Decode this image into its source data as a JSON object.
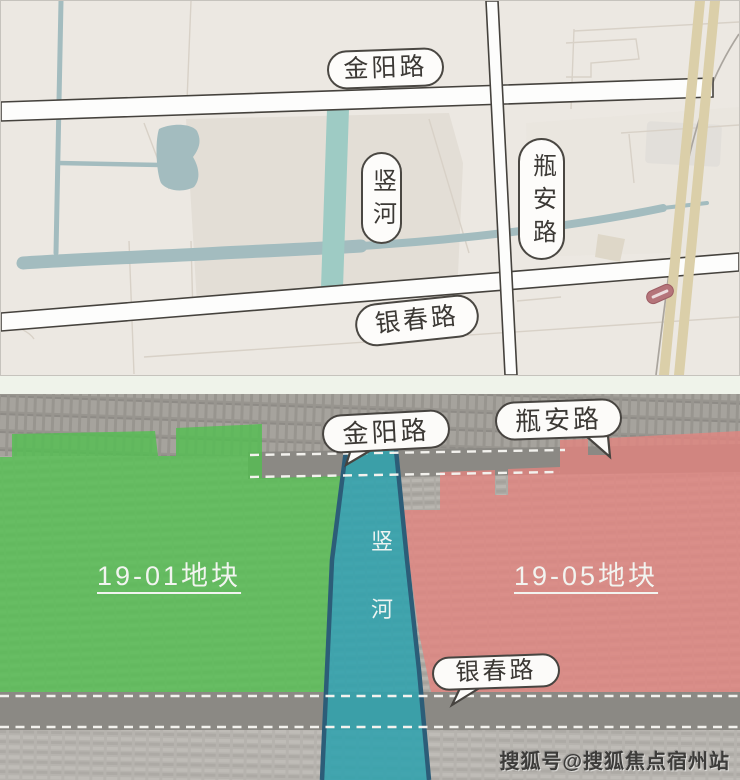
{
  "colors": {
    "map_bg": "#ece8e2",
    "parcel_block_top": "#e3ded6",
    "river_top": "#9ecbc4",
    "waterway": "#a3bcbf",
    "road_fill_top": "#fdfdfc",
    "highway_tan": "#dbcfa9",
    "marker_red": "#b5747a",
    "road_band_gray": "#8b8984",
    "parcel_green": "#52bf50",
    "parcel_red": "#e2847f",
    "river_bottom": "#2fa2ad",
    "river_bank": "#2c5d78"
  },
  "top_map": {
    "road_labels": {
      "jinyang": "金阳路",
      "shu_river": "竖河",
      "pingan": "瓶安路",
      "yinchun": "银春路"
    }
  },
  "bottom_map": {
    "bubble_labels": {
      "jinyang": "金阳路",
      "pingan": "瓶安路",
      "yinchun": "银春路"
    },
    "parcels": {
      "west": {
        "label": "19-01地块"
      },
      "east": {
        "label": "19-05地块"
      }
    },
    "river_chars": {
      "c1": "竖",
      "c2": "河"
    }
  },
  "watermark": {
    "text": "搜狐号@搜狐焦点宿州站"
  }
}
